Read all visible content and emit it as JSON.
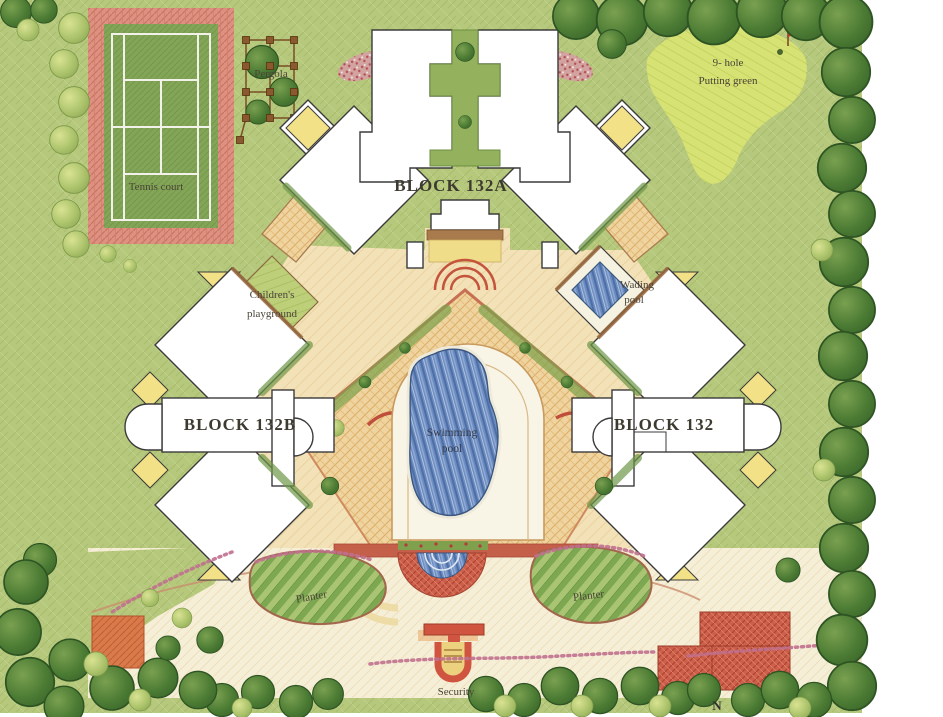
{
  "plan": {
    "labels": {
      "pergola": "Pergola",
      "tennis_court": "Tennis court",
      "putting_green_line1": "9- hole",
      "putting_green_line2": "Putting green",
      "block_132a": "BLOCK 132A",
      "block_132b": "BLOCK 132B",
      "block_132": "BLOCK 132",
      "childrens_playground_line1": "Children's",
      "childrens_playground_line2": "playground",
      "wading_pool_line1": "Wading",
      "wading_pool_line2": "pool",
      "swimming_pool_line1": "Swimming",
      "swimming_pool_line2": "pool",
      "planter_left": "Planter",
      "planter_right": "Planter",
      "security": "Security",
      "north": "N"
    },
    "colors": {
      "grass": "#b6c87c",
      "dark_tree": "#4c7c34",
      "putting_green": "#d7e275",
      "tennis_court_surface": "#83a557",
      "tennis_court_apron": "#dd9180",
      "plaza_paving": "#efd49f",
      "building_fill": "#ffffff",
      "building_outline": "#3b3b3b",
      "pool_water": "#6b8cc0",
      "accent_yellow": "#f3e187",
      "accent_red": "#cd604a",
      "road_cream": "#f6efd7"
    }
  }
}
